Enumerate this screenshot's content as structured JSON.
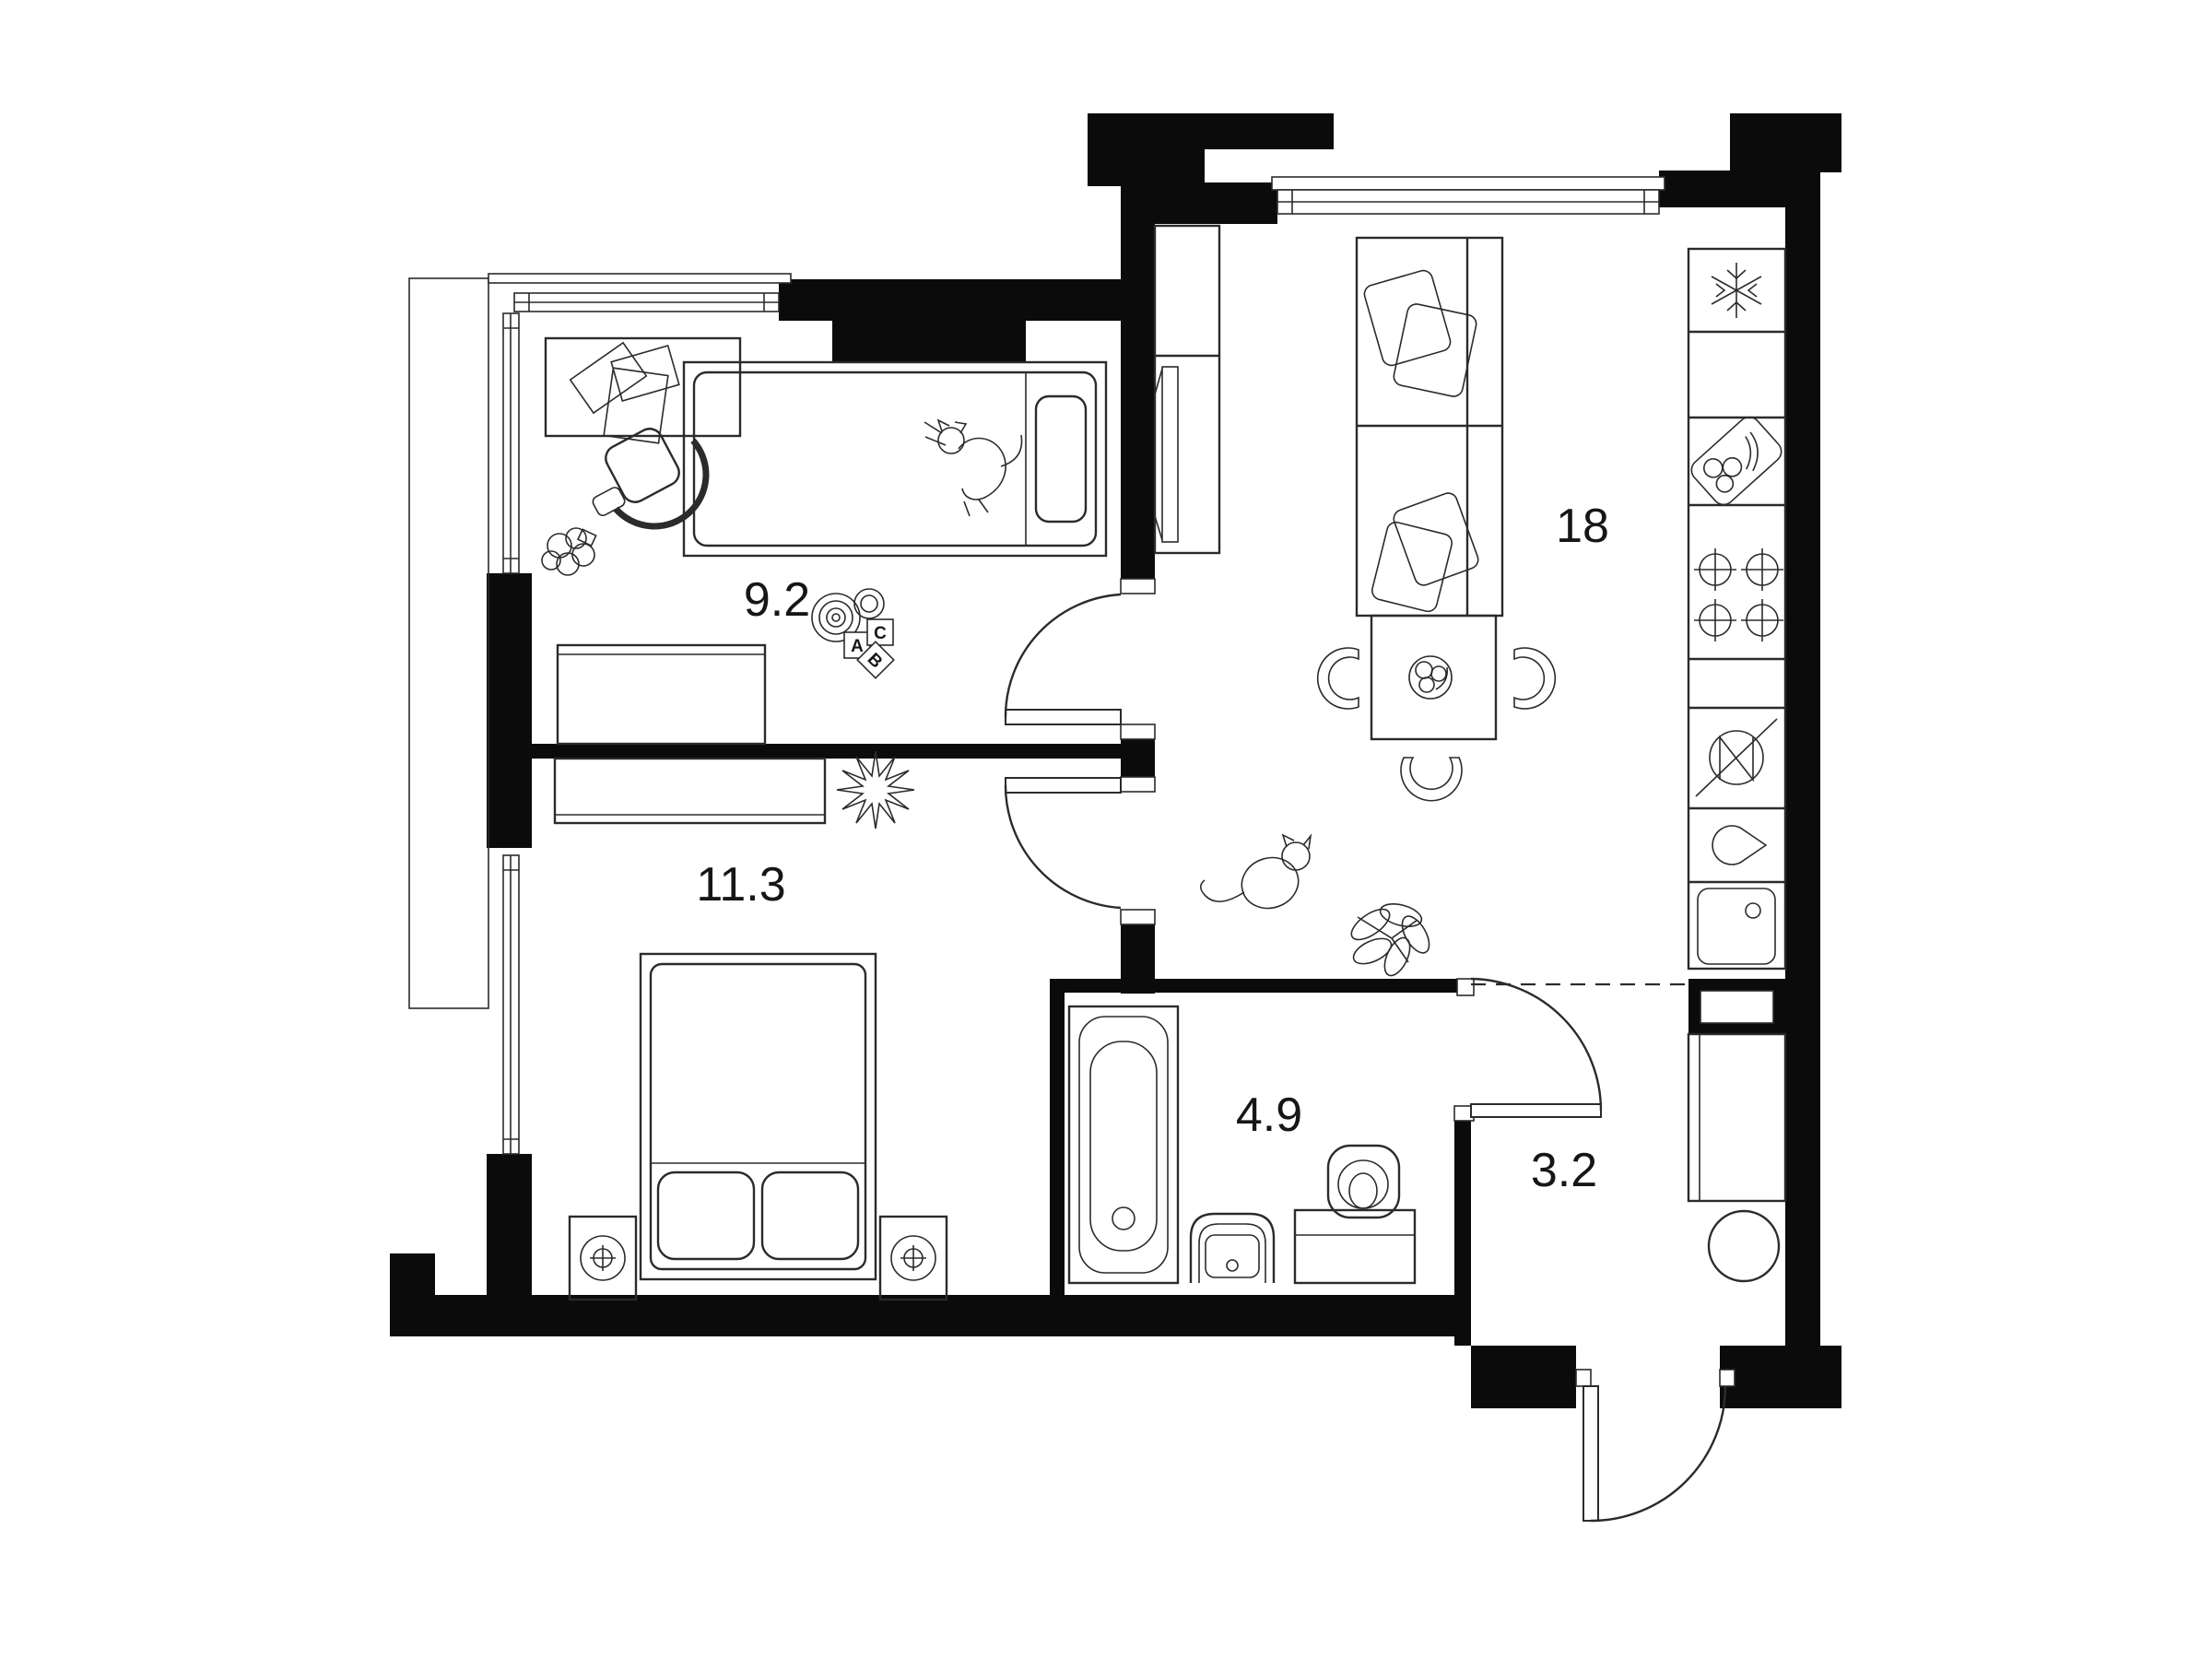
{
  "plan": {
    "type": "apartment-floor-plan",
    "background_color": "#ffffff",
    "wall_color": "#0b0b0b",
    "line_color": "#2b2b2b",
    "label_color": "#161616"
  },
  "rooms": [
    {
      "name": "child-room",
      "area_label": "9.2"
    },
    {
      "name": "living-kitchen",
      "area_label": "18"
    },
    {
      "name": "bedroom",
      "area_label": "11.3"
    },
    {
      "name": "bathroom",
      "area_label": "4.9"
    },
    {
      "name": "hallway",
      "area_label": "3.2"
    }
  ],
  "toy_blocks": [
    {
      "letter": "A"
    },
    {
      "letter": "C"
    },
    {
      "letter": "B"
    }
  ]
}
